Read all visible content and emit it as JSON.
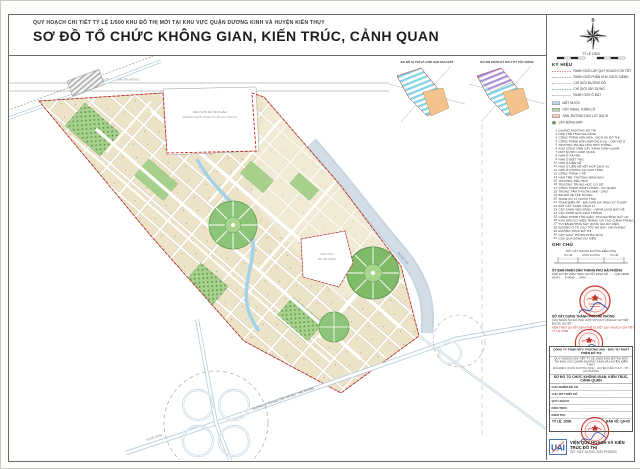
{
  "header": {
    "project_line": "QUY HOẠCH CHI TIẾT TỶ LỆ 1/500 KHU ĐÔ THỊ MỚI TẠI KHU VỰC QUẬN DƯƠNG KINH VÀ HUYỆN KIẾN THỤY",
    "title": "SƠ ĐỒ TỔ CHỨC KHÔNG GIAN, KIẾN TRÚC, CẢNH QUAN"
  },
  "insets": {
    "left_title": "SƠ ĐỒ VỊ TRÍ VÀ GIỚI HẠN KHU ĐẤT",
    "right_title": "SƠ ĐỒ PHÂN KỲ ĐẦU TƯ XÂY DỰNG"
  },
  "compass": {
    "north_label": "B"
  },
  "scalebar": {
    "label": "TỶ LỆ 1/500"
  },
  "legend": {
    "heading": "KÝ HIỆU",
    "lines": [
      {
        "css": "1.5px dashed #c8281c",
        "label": "RANH GIỚI LẬP QUY HOẠCH CHI TIẾT"
      },
      {
        "css": "1px dashed #555555",
        "label": "RANH GIỚI PHÂN KHU CHỨC NĂNG"
      },
      {
        "css": "1px dotted #c8281c",
        "label": "CHỈ GIỚI ĐƯỜNG ĐỎ"
      },
      {
        "css": "1px dashed #2a6db5",
        "label": "CHỈ GIỚI XÂY DỰNG"
      },
      {
        "css": "1px dotted #555555",
        "label": "RANH GIỚI Ô ĐẤT"
      }
    ],
    "areas": [
      {
        "bg": "#bcd9ec",
        "w": "14px",
        "label": "MẶT NƯỚC"
      },
      {
        "bg": "#b5d9a0",
        "w": "14px",
        "label": "CÂY XANH, THẢM CỎ"
      },
      {
        "bg": "#f4cab8",
        "w": "14px",
        "label": "SÂN, ĐƯỜNG DẠO LÁT GẠCH"
      },
      {
        "bg": "#69aa55",
        "w": "6px",
        "rad": "50%",
        "label": "CÂY BÓNG MÁT"
      }
    ],
    "items": [
      {
        "n": "1",
        "label": "QUẢNG TRƯỜNG ĐÔ THỊ"
      },
      {
        "n": "2",
        "label": "NHÀ THỂ THAO ĐA NĂNG"
      },
      {
        "n": "3",
        "label": "CÔNG TRÌNH VĂN HÓA - DỊCH VỤ ĐÔ THỊ"
      },
      {
        "n": "4",
        "label": "CÔNG TRÌNH HỖN HỢP DỊCH VỤ - CĂN HỘ Ở"
      },
      {
        "n": "5",
        "label": "TRƯỜNG TRUNG HỌC PHỔ THÔNG"
      },
      {
        "n": "6",
        "label": "KHU CÔNG VIÊN CÂY XANH CẢNH QUAN"
      },
      {
        "n": "7",
        "label": "MẶT NƯỚC CẢNH QUAN"
      },
      {
        "n": "8",
        "label": "NHÀ Ở XÃ HỘI"
      },
      {
        "n": "9",
        "label": "NHÀ Ở BIỆT THỰ"
      },
      {
        "n": "10",
        "label": "NHÀ Ở LIỀN KỀ"
      },
      {
        "n": "11",
        "label": "NHÀ Ở LIỀN KỀ KẾT HỢP DỊCH VỤ"
      },
      {
        "n": "12",
        "label": "NHÀ Ở CHUNG CƯ CAO TẦNG"
      },
      {
        "n": "13",
        "label": "CÔNG TRÌNH Y TẾ"
      },
      {
        "n": "14",
        "label": "NHÀ TRẺ, TRƯỜNG MẦM NON"
      },
      {
        "n": "15",
        "label": "TRƯỜNG TIỂU HỌC"
      },
      {
        "n": "16",
        "label": "TRƯỜNG TRUNG HỌC CƠ SỞ"
      },
      {
        "n": "17",
        "label": "CÔNG TRÌNH HÀNH CHÍNH - CƠ QUAN"
      },
      {
        "n": "18",
        "label": "TRUNG TÂM THƯƠNG MẠI - CHỢ"
      },
      {
        "n": "19",
        "label": "BÃI ĐỖ XE TẬP TRUNG"
      },
      {
        "n": "20",
        "label": "TRẠM XỬ LÝ NƯỚC THẢI"
      },
      {
        "n": "21",
        "label": "TRẠM BIẾN ÁP - ĐẦU MỐI HẠ TẦNG KỸ THUẬT"
      },
      {
        "n": "22",
        "label": "ĐẤT CÂY XANH CÁCH LY"
      },
      {
        "n": "23",
        "label": "CÂY XANH VEN SÔNG - HÀNH LANG BẢO VỆ"
      },
      {
        "n": "24",
        "label": "CÂY XANH NÚT GIAO THÔNG"
      },
      {
        "n": "25",
        "label": "CÔNG TRÌNH TÔN GIÁO, TÍN NGƯỠNG GIỮ LẠI"
      },
      {
        "n": "26",
        "label": "KHU DÂN CƯ HIỆN TRẠNG CẢI TẠO CHỈNH TRANG"
      },
      {
        "n": "27",
        "label": "TUYẾN ĐƯỜNG SẮT QUỐC GIA DỰ KIẾN"
      },
      {
        "n": "28",
        "label": "ĐƯỜNG Ô TÔ CAO TỐC HÀ NỘI - HẢI PHÒNG"
      },
      {
        "n": "29",
        "label": "ĐƯỜNG TRỤC ĐÔ THỊ"
      },
      {
        "n": "30",
        "label": "NÚT GIAO THÔNG KHÁC MỨC"
      },
      {
        "n": "31",
        "label": "CẦU QUA SÔNG DỰ KIẾN"
      }
    ]
  },
  "notes": {
    "heading": "GHI CHÚ",
    "cap": "MẶT CẮT NGANG ĐƯỜNG ĐIỂN HÌNH",
    "seg1": "VỈA HÈ",
    "seg2": "LÒNG ĐƯỜNG",
    "seg3": "VỈA HÈ"
  },
  "approvals": {
    "a1_title": "ỦY BAN NHÂN DÂN THÀNH PHỐ HẢI PHÒNG",
    "a1_sub": "PHÊ DUYỆT KÈM THEO QUYẾT ĐỊNH SỐ ……/QĐ-UBND NGÀY … THÁNG … NĂM ……",
    "a2_title": "SỞ XÂY DỰNG THÀNH PHỐ HẢI PHÒNG",
    "a2_sub": "XÁC NHẬN SƠ ĐỒ PHÙ HỢP VỚI QUY HOẠCH CHI TIẾT ĐƯỢC DUYỆT",
    "note": "KÈM THEO QUYẾT ĐỊNH PHÊ DUYỆT QUY HOẠCH CHI TIẾT TỶ LỆ 1/500"
  },
  "titleblock": {
    "company": "CÔNG TY TNHH MTV THƯƠNG MẠI - ĐẦU TƯ PHÁT TRIỂN ĐÔ THỊ",
    "project": "QUY HOẠCH CHI TIẾT TỶ LỆ 1/500 KHU ĐÔ THỊ MỚI TẠI KHU VỰC QUẬN DƯƠNG KINH VÀ HUYỆN KIẾN THỤY",
    "location": "ĐỊA ĐIỂM: QUẬN DƯƠNG KINH - HUYỆN KIẾN THỤY - TP. HẢI PHÒNG",
    "drawing": "SƠ ĐỒ TỔ CHỨC KHÔNG GIAN, KIẾN TRÚC, CẢNH QUAN",
    "rows": [
      {
        "role": "CHỦ NHIỆM ĐỒ ÁN",
        "val": "…………………………"
      },
      {
        "role": "CHỦ TRÌ THIẾT KẾ",
        "val": "…………………………"
      },
      {
        "role": "QUY HOẠCH",
        "val": "…………………………"
      },
      {
        "role": "KIẾN TRÚC",
        "val": "…………………………"
      },
      {
        "role": "KIỂM TRA",
        "val": "…………………………"
      }
    ],
    "scale_label": "TỶ LỆ",
    "scale_val": "1/500",
    "sheet_label": "BẢN VẼ",
    "sheet_val": "QH-05"
  },
  "footer": {
    "logo": "UAI",
    "institute": "VIỆN QUY HOẠCH VÀ KIẾN TRÚC ĐÔ THỊ",
    "sub": "SỞ XÂY DỰNG HẢI PHÒNG"
  },
  "map": {
    "labels": {
      "top_road": "ĐƯỜNG PHẠM VĂN ĐỒNG",
      "river": "SÔNG HE",
      "highway": "ĐƯỜNG Ô TÔ CAO TỐC HÀ NỘI - HẢI PHÒNG",
      "doson": "ĐI ĐỒ SƠN",
      "excl1a": "KHU VỰC DỰ ÁN KHÁC",
      "excl1b": "(KHÔNG THUỘC PHẠM VI LẬP QUY HOẠCH)",
      "excl2a": "KHU VỰC",
      "excl2b": "DỰ ÁN KHÁC"
    }
  },
  "colors": {
    "boundary_red": "#c8281c",
    "water": "#c2cfdd",
    "canal": "#a5d2e6",
    "green": "#a7d08c",
    "beige": "#efe6ca",
    "hatch_cyan": "#7fd2e4",
    "hatch_purple": "#a98fd6",
    "orange": "#f3c38f",
    "highway": "#b7cddd"
  }
}
